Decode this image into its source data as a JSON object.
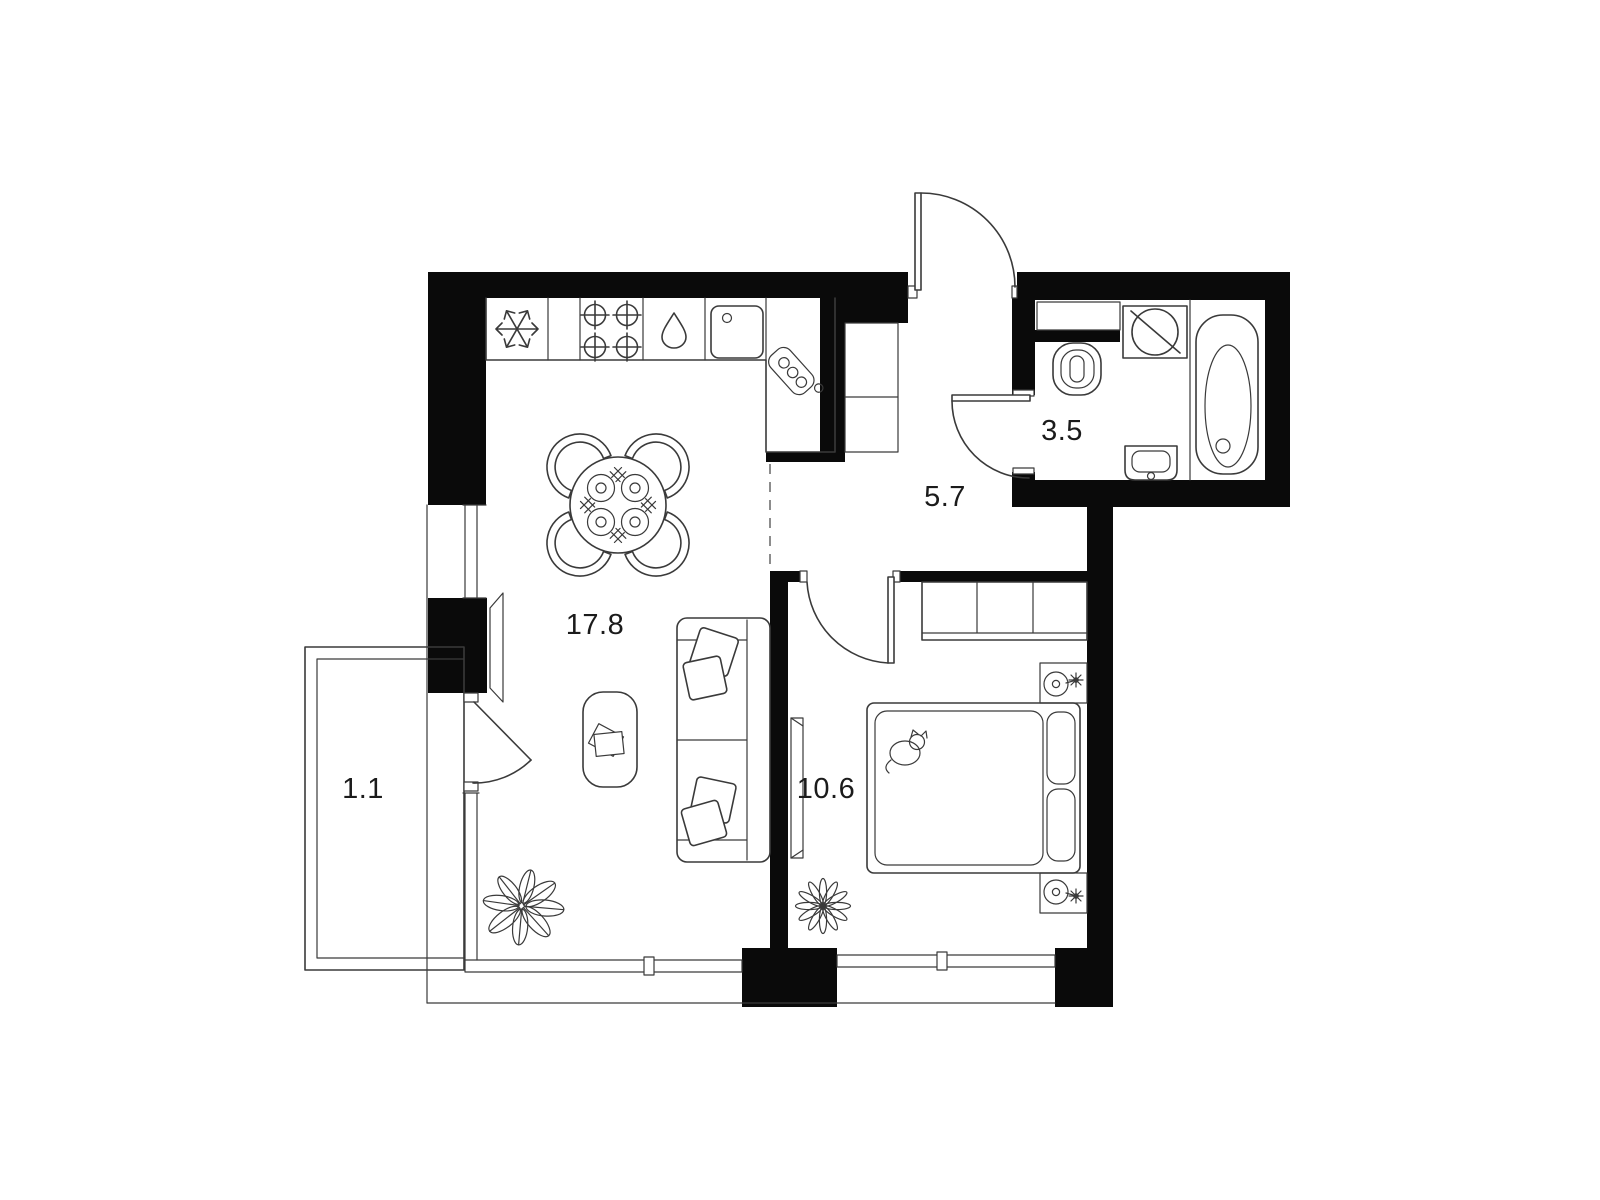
{
  "floor_plan": {
    "background_color": "#ffffff",
    "wall_color": "#0a0a0a",
    "line_color": "#3a3a3a",
    "rooms": [
      {
        "id": "living-kitchen",
        "label": "17.8"
      },
      {
        "id": "hallway",
        "label": "5.7"
      },
      {
        "id": "bathroom",
        "label": "3.5"
      },
      {
        "id": "bedroom",
        "label": "10.6"
      },
      {
        "id": "balcony",
        "label": "1.1"
      }
    ],
    "fixtures": [
      "fridge",
      "stove",
      "dishwasher",
      "kitchen-sink",
      "cutting-board",
      "dining-table",
      "chairs",
      "plates",
      "sofa",
      "pillows",
      "coffee-table",
      "tv",
      "plant-living",
      "plant-bedroom",
      "entrance-door",
      "hall-closet",
      "toilet",
      "washing-machine",
      "bathtub",
      "bathroom-sink",
      "wardrobe",
      "bed",
      "cat",
      "nightstand",
      "lamp",
      "balcony-parapet"
    ]
  }
}
